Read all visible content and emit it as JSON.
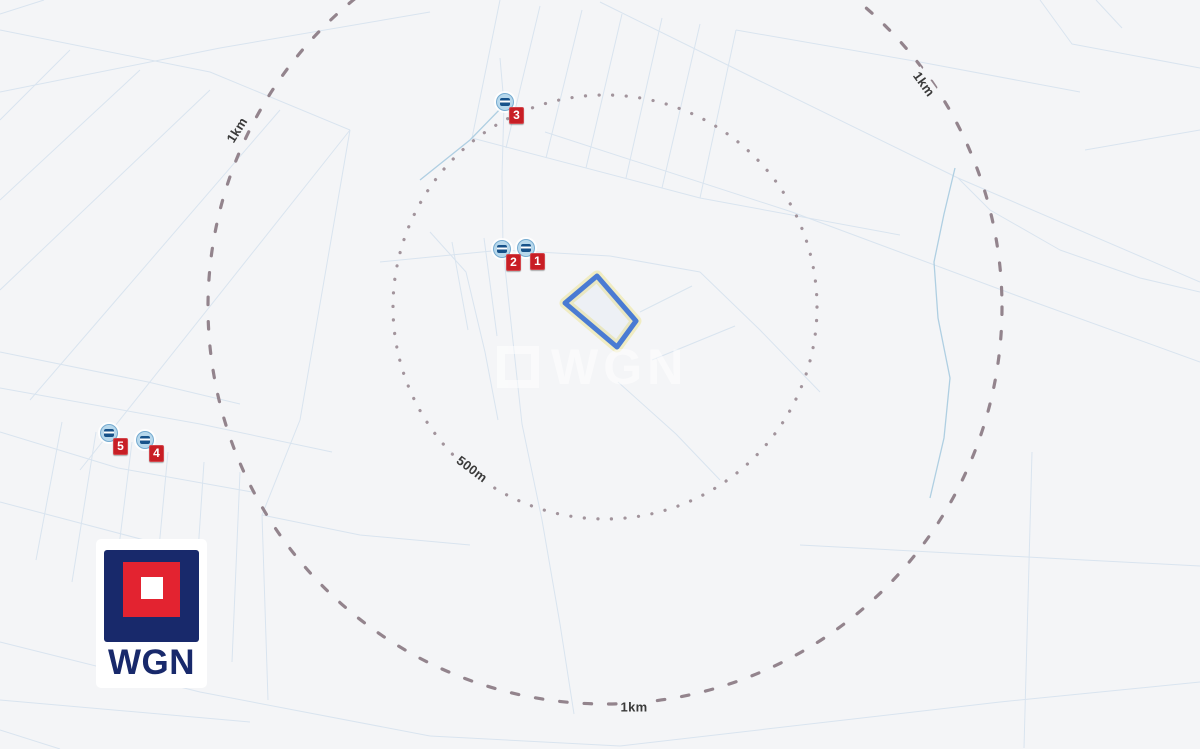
{
  "colors": {
    "map_background": "#f4f5f7",
    "parcel_line": "#d9e4ef",
    "ring_dash": "#93848d",
    "ring_dot": "#a2949c",
    "plot_outline": "#4a7bd3",
    "plot_glow": "#efeab8",
    "marker_badge_red": "#c81e25",
    "marker_icon_blue": "#b7d8ec",
    "logo_navy": "#18296b",
    "logo_red": "#e32330"
  },
  "rings": {
    "inner_radius_label": "500m",
    "outer_radius_label": "1km"
  },
  "ring_labels": [
    {
      "text": "1km"
    },
    {
      "text": "1km"
    },
    {
      "text": "500m"
    },
    {
      "text": "1km"
    }
  ],
  "markers": [
    {
      "number": "1"
    },
    {
      "number": "2"
    },
    {
      "number": "3"
    },
    {
      "number": "4"
    },
    {
      "number": "5"
    }
  ],
  "watermark": {
    "text": "WGN"
  },
  "logo": {
    "text": "WGN"
  }
}
